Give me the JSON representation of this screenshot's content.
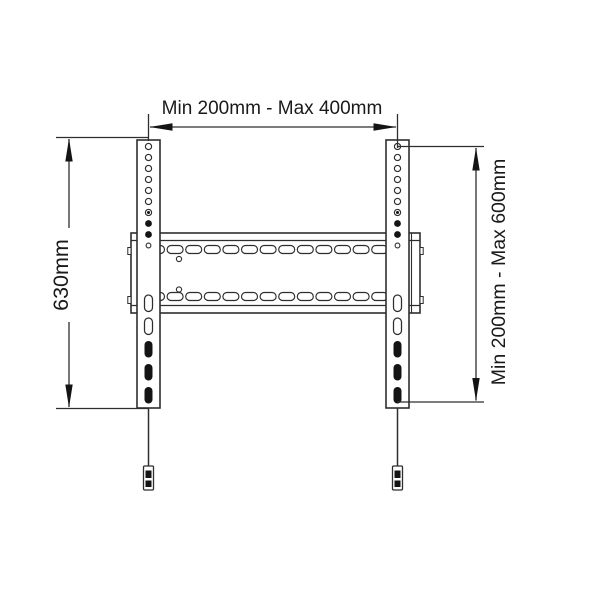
{
  "diagram": {
    "labels": {
      "top": "Min 200mm - Max 400mm",
      "left": "630mm",
      "right": "Min 200mm - Max 600mm"
    },
    "colors": {
      "background": "#ffffff",
      "stroke": "#2e2e2e",
      "dark_fill": "#141414",
      "text": "#1a1a1a",
      "part_fill": "#ffffff"
    },
    "geometry": {
      "canvas": {
        "w": 600,
        "h": 600
      },
      "rails": [
        {
          "x": 137,
          "y": 140,
          "w": 23,
          "h": 268,
          "cx": 148.5
        },
        {
          "x": 386,
          "y": 140,
          "w": 23,
          "h": 268,
          "cx": 397.5
        }
      ],
      "rail_holes": {
        "start_y": 146.5,
        "pitch": 11,
        "count": 10,
        "r": 3.1,
        "states": [
          "ring",
          "ring",
          "ring",
          "ring",
          "ring",
          "ring",
          "dot",
          "filled",
          "filled",
          "small"
        ]
      },
      "rail_slots": {
        "start_y": 295,
        "pitch": 23,
        "count": 5,
        "w": 8,
        "h": 16.5,
        "states": [
          "ring",
          "ring",
          "filled",
          "filled",
          "filled"
        ]
      },
      "plate": {
        "x": 131,
        "y": 233,
        "w": 289,
        "h": 80,
        "inner_top": 240.5,
        "inner_bottom": 305.5,
        "inner_right_x": 411.5,
        "slot_rows": [
          245.5,
          292.5
        ],
        "slot": {
          "start_x": 148.5,
          "pitch": 18.6,
          "count": 14,
          "w": 16,
          "h": 8
        },
        "holes": [
          {
            "cx": 179,
            "cy": 259
          },
          {
            "cx": 179,
            "cy": 289.5
          }
        ],
        "nub_ys": [
          247.5,
          296.5
        ]
      },
      "cords": [
        {
          "cx": 148.5
        },
        {
          "cx": 397.5
        }
      ],
      "cord": {
        "top": 408,
        "bottom": 466,
        "tab_w": 10,
        "tab_h": 24
      },
      "dims": {
        "top": {
          "line_y": 127,
          "x1": 148.5,
          "x2": 397.5,
          "ext_top": 114,
          "ext_bot": 141,
          "label_cx": 272,
          "label_cy": 108.5
        },
        "left": {
          "line_x": 69,
          "y1": 137.5,
          "y2": 408.5,
          "tick_x1": 56,
          "tick_x2": 148,
          "gap_y1": 228,
          "gap_y2": 322,
          "label_cx": 61,
          "label_cy": 275
        },
        "right": {
          "line_x": 476,
          "y1": 146.5,
          "y2": 402,
          "tick_x1": 397.5,
          "tick_x2": 484,
          "label_cx": 499,
          "label_cy": 272
        }
      },
      "arrow": {
        "len": 23,
        "half": 3.7
      }
    }
  }
}
